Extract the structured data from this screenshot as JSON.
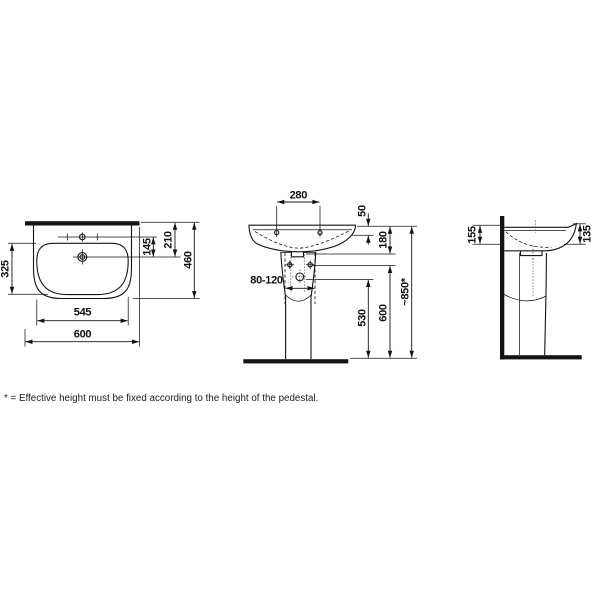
{
  "meta": {
    "background": "#ffffff",
    "line_color": "#141414"
  },
  "views": {
    "top": {
      "dims": {
        "d325": "325",
        "d545": "545",
        "d600": "600",
        "d145": "145",
        "d210": "210",
        "d460": "460"
      }
    },
    "front": {
      "dims": {
        "d280": "280",
        "d50": "50",
        "d180": "180",
        "d80120": "80-120",
        "d530": "530",
        "d600": "600",
        "d850": "~850*"
      }
    },
    "side": {
      "dims": {
        "d155": "155",
        "d135": "135"
      }
    }
  },
  "footnote": "* = Effective height must be fixed according to the height of the pedestal."
}
